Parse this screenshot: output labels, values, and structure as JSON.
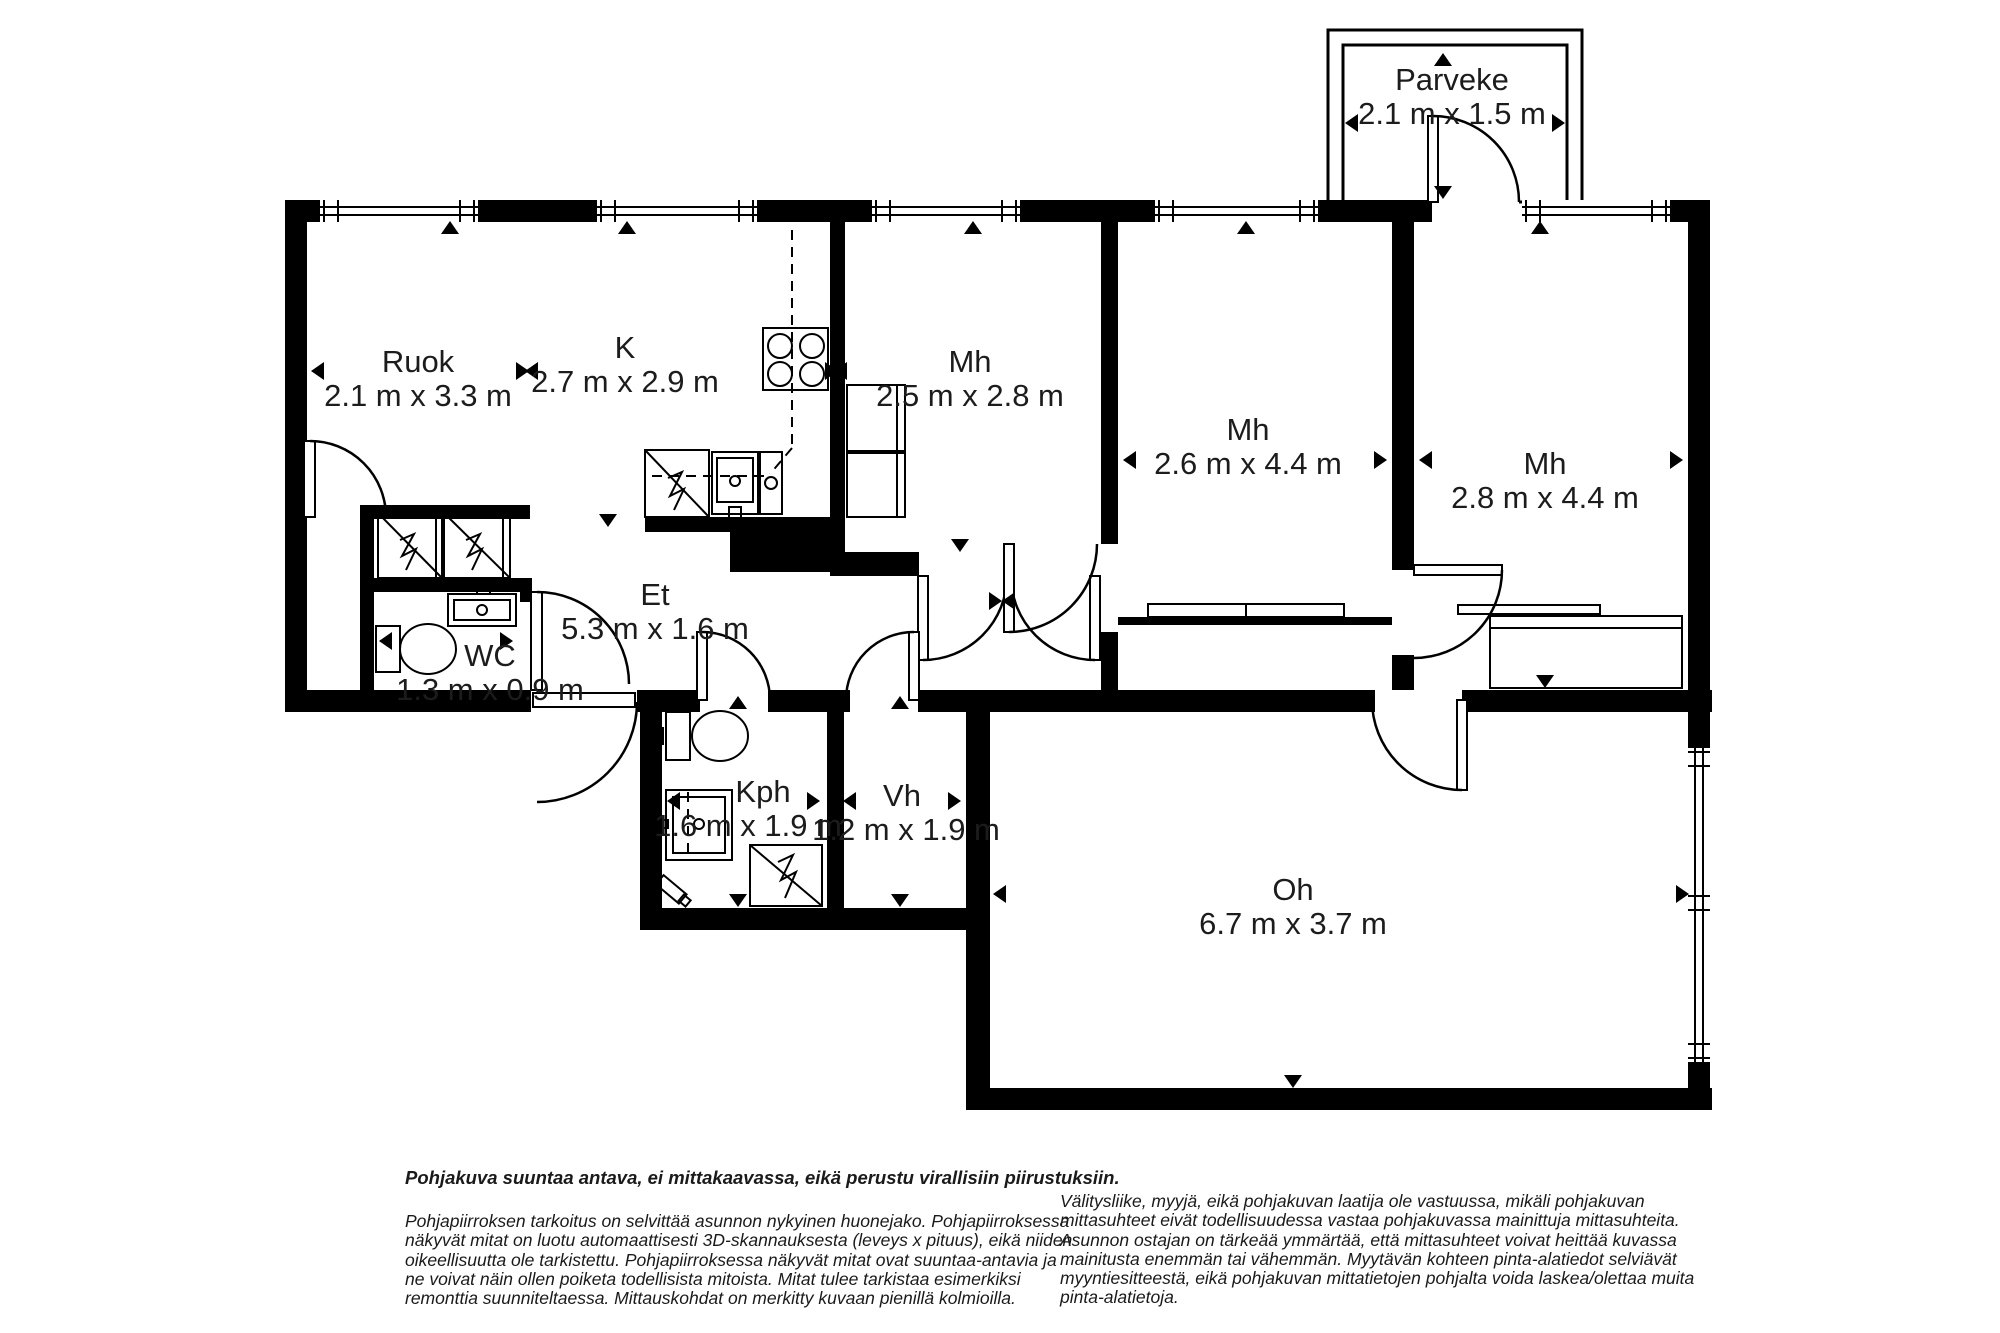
{
  "rooms": [
    {
      "name": "Parveke",
      "dims": "2.1 m x 1.5 m"
    },
    {
      "name": "Ruok",
      "dims": "2.1 m x 3.3 m"
    },
    {
      "name": "K",
      "dims": "2.7 m x 2.9 m"
    },
    {
      "name": "Mh",
      "dims": "2.5 m x 2.8 m"
    },
    {
      "name": "Mh",
      "dims": "2.6 m x 4.4 m"
    },
    {
      "name": "Mh",
      "dims": "2.8 m x 4.4 m"
    },
    {
      "name": "Et",
      "dims": "5.3 m x 1.6 m"
    },
    {
      "name": "WC",
      "dims": "1.3 m x 0.9 m"
    },
    {
      "name": "Kph",
      "dims": "1.6 m x 1.9 m"
    },
    {
      "name": "Vh",
      "dims": "1.2 m x 1.9 m"
    },
    {
      "name": "Oh",
      "dims": "6.7 m x 3.7 m"
    }
  ],
  "disclaimer_left": {
    "bold_line": "Pohjakuva suuntaa antava, ei mittakaavassa, eikä perustu virallisiin piirustuksiin.",
    "lines": [
      "Pohjapiirroksen tarkoitus on selvittää asunnon nykyinen huonejako. Pohjapiirroksessa",
      "näkyvät mitat on luotu automaattisesti 3D-skannauksesta (leveys x pituus), eikä niiden",
      "oikeellisuutta ole tarkistettu. Pohjapiirroksessa näkyvät mitat ovat suuntaa-antavia ja",
      "ne voivat näin ollen poiketa todellisista mitoista. Mitat tulee tarkistaa esimerkiksi",
      "remonttia suunniteltaessa. Mittauskohdat on merkitty kuvaan pienillä kolmioilla."
    ]
  },
  "disclaimer_right": {
    "lines": [
      "Välitysliike, myyjä, eikä pohjakuvan laatija ole vastuussa, mikäli pohjakuvan",
      "mittasuhteet eivät todellisuudessa vastaa pohjakuvassa mainittuja mittasuhteita.",
      "Asunnon ostajan on tärkeää ymmärtää, että mittasuhteet voivat heittää kuvassa",
      "mainitusta enemmän tai vähemmän. Myytävän kohteen pinta-alatiedot selviävät",
      "myyntiesitteestä, eikä pohjakuvan mittatietojen pohjalta voida laskea/olettaa muita",
      "pinta-alatietoja."
    ]
  },
  "colors": {
    "wall": "#000000",
    "background": "#ffffff",
    "text": "#1c1c1c"
  }
}
